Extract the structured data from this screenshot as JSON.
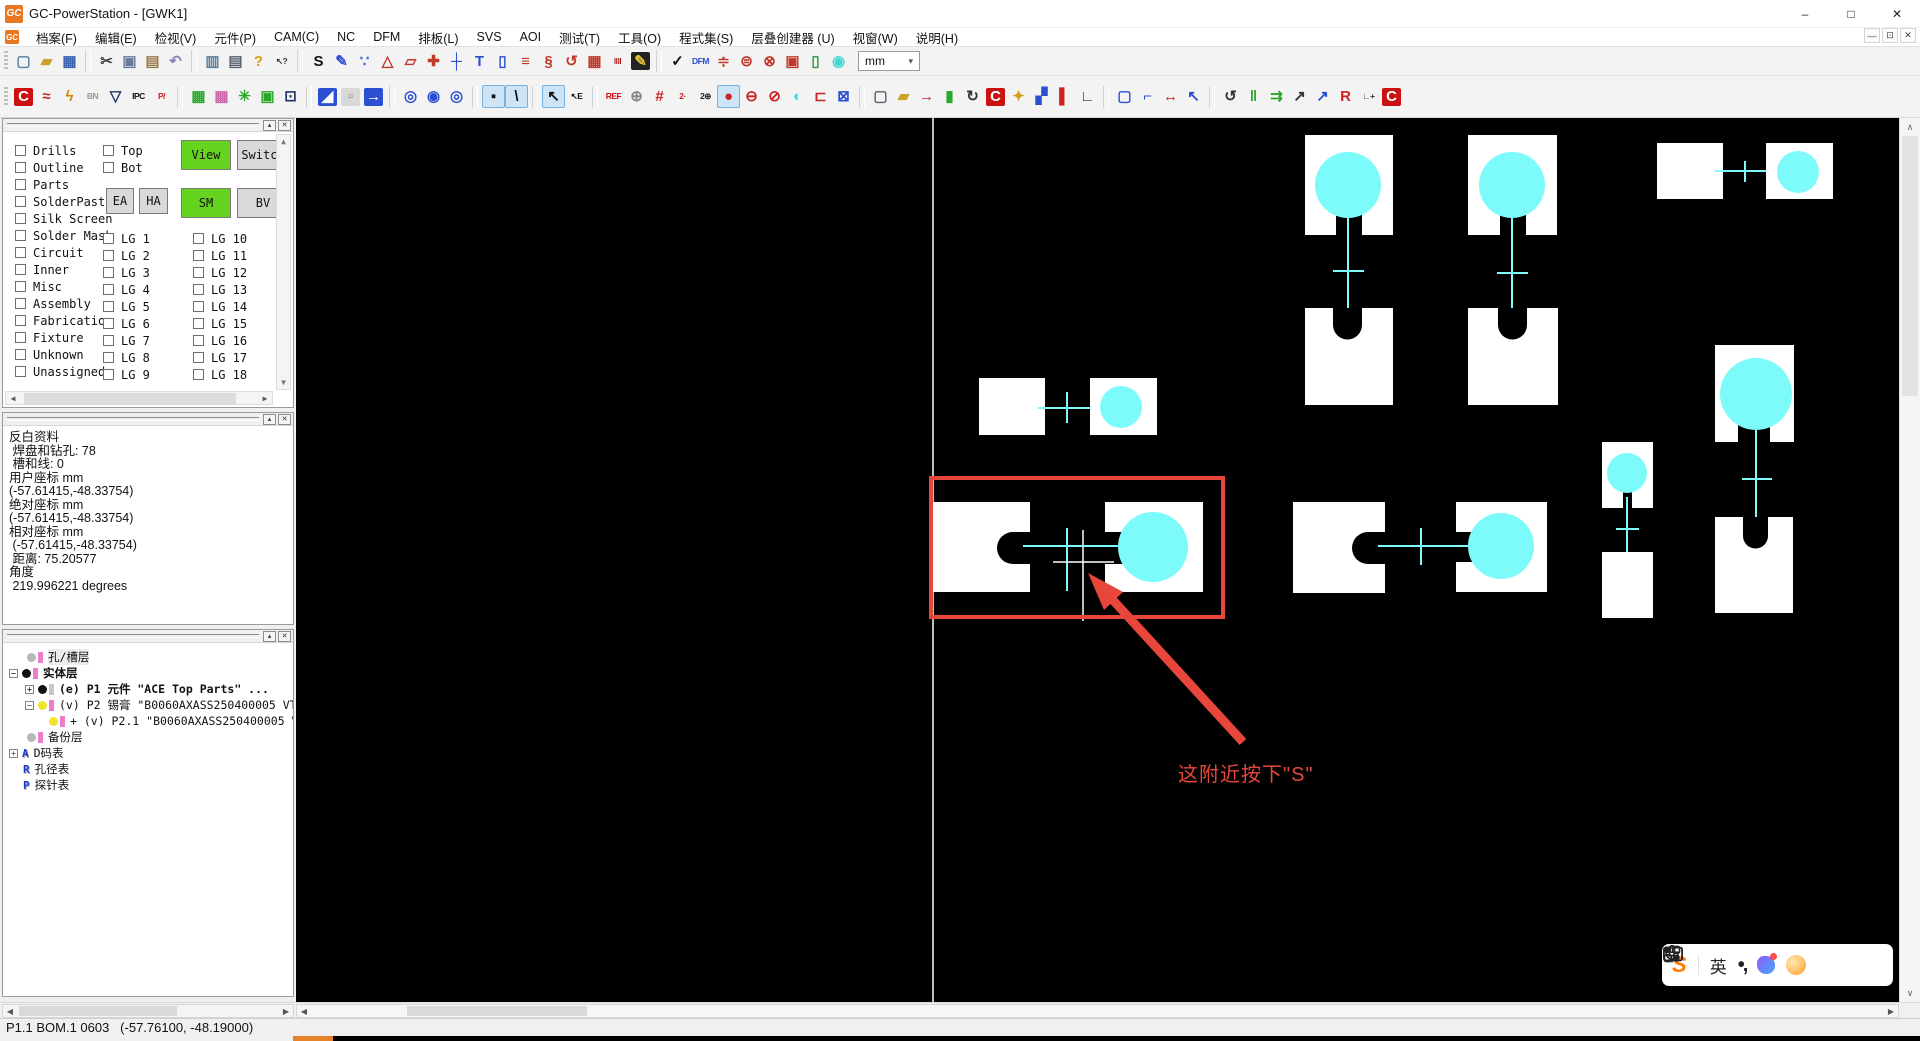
{
  "window": {
    "title": "GC-PowerStation - [GWK1]",
    "logo": "GC"
  },
  "titlebar": {
    "minimize": "–",
    "maximize": "□",
    "close": "✕"
  },
  "mdi": {
    "minimize": "—",
    "restore": "⊡",
    "close": "✕"
  },
  "menubar": {
    "items": [
      {
        "name": "menu-file",
        "label": "档案(F)"
      },
      {
        "name": "menu-edit",
        "label": "编辑(E)"
      },
      {
        "name": "menu-view",
        "label": "检视(V)"
      },
      {
        "name": "menu-part",
        "label": "元件(P)"
      },
      {
        "name": "menu-cam",
        "label": "CAM(C)"
      },
      {
        "name": "menu-nc",
        "label": "NC"
      },
      {
        "name": "menu-dfm",
        "label": "DFM"
      },
      {
        "name": "menu-layout",
        "label": "排板(L)"
      },
      {
        "name": "menu-svs",
        "label": "SVS"
      },
      {
        "name": "menu-aoi",
        "label": "AOI"
      },
      {
        "name": "menu-test",
        "label": "测试(T)"
      },
      {
        "name": "menu-tools",
        "label": "工具(O)"
      },
      {
        "name": "menu-programs",
        "label": "程式集(S)"
      },
      {
        "name": "menu-stackup",
        "label": "层叠创建器 (U)"
      },
      {
        "name": "menu-window",
        "label": "视窗(W)"
      },
      {
        "name": "menu-help",
        "label": "说明(H)"
      }
    ]
  },
  "toolbar1": {
    "items": [
      {
        "name": "new-file-button",
        "glyph": "▢",
        "fg": "#5a7da0"
      },
      {
        "name": "open-folder-button",
        "glyph": "▰",
        "fg": "#c9a227"
      },
      {
        "name": "save-button",
        "glyph": "▦",
        "fg": "#3a5fae"
      },
      {
        "type": "sep"
      },
      {
        "name": "cut-button",
        "glyph": "✂",
        "fg": "#444444"
      },
      {
        "name": "copy-button",
        "glyph": "▣",
        "fg": "#6a7a9a"
      },
      {
        "name": "paste-button",
        "glyph": "▤",
        "fg": "#9a7a4a"
      },
      {
        "name": "undo-button",
        "glyph": "↶",
        "fg": "#8a8ab0"
      },
      {
        "type": "sep"
      },
      {
        "name": "report-button",
        "glyph": "▥",
        "fg": "#5a7da0"
      },
      {
        "name": "print-button",
        "glyph": "▤",
        "fg": "#556070"
      },
      {
        "name": "help-button",
        "glyph": "?",
        "fg": "#d4a017"
      },
      {
        "name": "context-help-button",
        "glyph": "↖?",
        "fg": "#333333"
      },
      {
        "type": "sep"
      },
      {
        "name": "snap-mode-button",
        "glyph": "S",
        "fg": "#111111"
      },
      {
        "name": "draw-pencil-button",
        "glyph": "✎",
        "fg": "#2a4fd0"
      },
      {
        "name": "add-points-button",
        "glyph": "∵",
        "fg": "#2a6fd0"
      },
      {
        "name": "polyline-button",
        "glyph": "△",
        "fg": "#c03a2a"
      },
      {
        "name": "select-polygon-button",
        "glyph": "▱",
        "fg": "#c03a2a"
      },
      {
        "name": "transform-button",
        "glyph": "✚",
        "fg": "#c03a2a"
      },
      {
        "name": "axis-button",
        "glyph": "┼",
        "fg": "#2a4fd0"
      },
      {
        "name": "text-tool-button",
        "glyph": "T",
        "fg": "#2a4fd0"
      },
      {
        "name": "rect-tool-button",
        "glyph": "▯",
        "fg": "#2a4fd0"
      },
      {
        "name": "layer-stack-button",
        "glyph": "≡",
        "fg": "#c03a2a"
      },
      {
        "name": "shrink-button",
        "glyph": "§",
        "fg": "#c03a2a"
      },
      {
        "name": "rotate-sel-button",
        "glyph": "↺",
        "fg": "#c03a2a"
      },
      {
        "name": "save-layer-button",
        "glyph": "▦",
        "fg": "#c03a2a"
      },
      {
        "name": "barcode-button",
        "glyph": "‖‖",
        "fg": "#aa1111"
      },
      {
        "name": "marker-pen-button",
        "glyph": "✎",
        "fg": "#e8c23a",
        "bg": "#222222"
      },
      {
        "type": "sep"
      },
      {
        "name": "verify-check-button",
        "glyph": "✓",
        "fg": "#111111"
      },
      {
        "name": "dfm-check-button",
        "glyph": "DFM",
        "fg": "#2a4fd0"
      },
      {
        "name": "compare-stack-button",
        "glyph": "≑",
        "fg": "#c03a2a"
      },
      {
        "name": "disc-lines-button",
        "glyph": "⊜",
        "fg": "#c03a2a"
      },
      {
        "name": "disc-mesh-button",
        "glyph": "⊗",
        "fg": "#c03a2a"
      },
      {
        "name": "pad-pair-button",
        "glyph": "▣",
        "fg": "#c03a2a"
      },
      {
        "name": "outline-rect-button",
        "glyph": "▯",
        "fg": "#2a9a3a"
      },
      {
        "name": "droplet-button",
        "glyph": "◉",
        "fg": "#3fd6d6"
      }
    ]
  },
  "unit_select": {
    "value": "mm",
    "chevron": "▾"
  },
  "toolbar2": {
    "items": [
      {
        "name": "c-net-button",
        "glyph": "C",
        "fg": "#ffffff",
        "bg": "#cc1111"
      },
      {
        "name": "net-compare-button",
        "glyph": "≈",
        "fg": "#cc2222"
      },
      {
        "name": "spark-button",
        "glyph": "ϟ",
        "fg": "#cc8800"
      },
      {
        "name": "bn-tool-button",
        "glyph": "BN",
        "fg": "#999999"
      },
      {
        "name": "filter-funnel-button",
        "glyph": "▽",
        "fg": "#223366"
      },
      {
        "name": "ipc-export-button",
        "glyph": "IPC",
        "fg": "#111111"
      },
      {
        "name": "p-slash-button",
        "glyph": "P/",
        "fg": "#cc2222"
      },
      {
        "type": "sep"
      },
      {
        "name": "panel-array-button",
        "glyph": "▦",
        "fg": "#2aa82a"
      },
      {
        "name": "panel-array-alt-button",
        "glyph": "▦",
        "fg": "#cc66aa"
      },
      {
        "name": "thermal-burst-button",
        "glyph": "✳",
        "fg": "#2aa82a"
      },
      {
        "name": "pad-in-frame-button",
        "glyph": "▣",
        "fg": "#2aa82a"
      },
      {
        "name": "inspect-pad-button",
        "glyph": "⊡",
        "fg": "#223366"
      },
      {
        "type": "sep"
      },
      {
        "name": "view-full-button",
        "glyph": "◢",
        "fg": "#ffffff",
        "bg": "#2a4fd0"
      },
      {
        "name": "view-grid-button",
        "glyph": "▫",
        "fg": "#888888",
        "bg": "#d8d8d8"
      },
      {
        "name": "view-pan-button",
        "glyph": "→",
        "fg": "#ffffff",
        "bg": "#2a4fd0"
      },
      {
        "type": "sep"
      },
      {
        "name": "zoom-highlight-1-button",
        "glyph": "◎",
        "fg": "#2a4fd0"
      },
      {
        "name": "zoom-highlight-2-button",
        "glyph": "◉",
        "fg": "#2a4fd0"
      },
      {
        "name": "zoom-highlight-3-button",
        "glyph": "◎",
        "fg": "#2a4fd0"
      },
      {
        "type": "sep"
      },
      {
        "name": "point-mode-button",
        "glyph": "▪",
        "fg": "#111111",
        "hl": true
      },
      {
        "name": "line-mode-button",
        "glyph": "\\",
        "fg": "#111111",
        "hl": true
      },
      {
        "type": "sep"
      },
      {
        "name": "select-cursor-button",
        "glyph": "↖",
        "fg": "#111111",
        "hl": true
      },
      {
        "name": "select-edit-button",
        "glyph": "↖E",
        "fg": "#111111"
      },
      {
        "type": "sep"
      },
      {
        "name": "ref-grid-button",
        "glyph": "REF",
        "fg": "#cc1111"
      },
      {
        "name": "sphere-button",
        "glyph": "⊕",
        "fg": "#888888"
      },
      {
        "name": "numbering-button",
        "glyph": "#",
        "fg": "#cc2222"
      },
      {
        "name": "step2-button",
        "glyph": "2·",
        "fg": "#cc2222"
      },
      {
        "name": "target2-button",
        "glyph": "2⊕",
        "fg": "#222222"
      },
      {
        "name": "pad-ellipse-button",
        "glyph": "●",
        "fg": "#cc2222",
        "hl": true
      },
      {
        "name": "pad-line-left-button",
        "glyph": "⊖",
        "fg": "#cc2222"
      },
      {
        "name": "pad-line-mid-button",
        "glyph": "⊘",
        "fg": "#cc2222"
      },
      {
        "name": "pad-fill-cyan-button",
        "glyph": "◐",
        "fg": "#3fd6d6"
      },
      {
        "name": "pad-open-right-button",
        "glyph": "⊏",
        "fg": "#cc2222"
      },
      {
        "name": "pad-cross-frame-button",
        "glyph": "⊠",
        "fg": "#2a4fd0"
      },
      {
        "type": "sep"
      },
      {
        "name": "new-doc-button",
        "glyph": "▢",
        "fg": "#556677"
      },
      {
        "name": "open-folder2-button",
        "glyph": "▰",
        "fg": "#c9a227"
      },
      {
        "name": "import-door-button",
        "glyph": "→",
        "fg": "#cc2222"
      },
      {
        "name": "green-panel-button",
        "glyph": "▮",
        "fg": "#2aa82a"
      },
      {
        "name": "rotate-view-button",
        "glyph": "↻",
        "fg": "#333333"
      },
      {
        "name": "c-marker-button",
        "glyph": "C",
        "fg": "#ffffff",
        "bg": "#cc1111"
      },
      {
        "name": "lamp-button",
        "glyph": "✦",
        "fg": "#d4a017"
      },
      {
        "name": "split-panels-button",
        "glyph": "▞",
        "fg": "#2a4fd0"
      },
      {
        "name": "panel-cursor-button",
        "glyph": "▌",
        "fg": "#cc2222"
      },
      {
        "name": "measure-axis-button",
        "glyph": "∟",
        "fg": "#333333"
      },
      {
        "type": "sep"
      },
      {
        "name": "select-rect-dashed-button",
        "glyph": "▢",
        "fg": "#2a4fd0"
      },
      {
        "name": "corner-snap-button",
        "glyph": "⌐",
        "fg": "#2a4fd0"
      },
      {
        "name": "transform-handles-button",
        "glyph": "↔",
        "fg": "#cc2222"
      },
      {
        "name": "corner-arrow-button",
        "glyph": "↖",
        "fg": "#2a4fd0"
      },
      {
        "type": "sep"
      },
      {
        "name": "rotate-ccw-button",
        "glyph": "↺",
        "fg": "#333333"
      },
      {
        "name": "align-columns-button",
        "glyph": "‖",
        "fg": "#2aa82a"
      },
      {
        "name": "distribute-button",
        "glyph": "⇉",
        "fg": "#2aa82a"
      },
      {
        "name": "chart-rise-button",
        "glyph": "↗",
        "fg": "#333333"
      },
      {
        "name": "chart-rise2-button",
        "glyph": "↗",
        "fg": "#2a4fd0"
      },
      {
        "name": "r-layers-button",
        "glyph": "R",
        "fg": "#cc2222"
      },
      {
        "name": "chart-add-button",
        "glyph": "∟+",
        "fg": "#333333"
      },
      {
        "name": "c-stop-button",
        "glyph": "C",
        "fg": "#ffffff",
        "bg": "#cc1111"
      }
    ]
  },
  "layers_panel": {
    "categories": [
      {
        "name": "layer-drills-checkbox",
        "label": "Drills"
      },
      {
        "name": "layer-outline-checkbox",
        "label": "Outline"
      },
      {
        "name": "layer-parts-checkbox",
        "label": "Parts"
      },
      {
        "name": "layer-solderpaste-checkbox",
        "label": "SolderPaste"
      },
      {
        "name": "layer-silk-screen-checkbox",
        "label": "Silk Screen"
      },
      {
        "name": "layer-solder-mask-checkbox",
        "label": "Solder Mask"
      },
      {
        "name": "layer-circuit-checkbox",
        "label": "Circuit"
      },
      {
        "name": "layer-inner-checkbox",
        "label": "Inner"
      },
      {
        "name": "layer-misc-checkbox",
        "label": "Misc"
      },
      {
        "name": "layer-assembly-checkbox",
        "label": "Assembly"
      },
      {
        "name": "layer-fabrication-checkbox",
        "label": "Fabrication"
      },
      {
        "name": "layer-fixture-checkbox",
        "label": "Fixture"
      },
      {
        "name": "layer-unknown-checkbox",
        "label": "Unknown"
      },
      {
        "name": "layer-unassigned-checkbox",
        "label": "Unassigned"
      }
    ],
    "sides": [
      {
        "name": "side-top-checkbox",
        "label": "Top"
      },
      {
        "name": "side-bot-checkbox",
        "label": "Bot"
      }
    ],
    "buttons": {
      "view": "View",
      "switch": "Switch",
      "ea": "EA",
      "ha": "HA",
      "sm": "SM",
      "bv": "BV"
    },
    "lg_left": [
      {
        "name": "lg-1-checkbox",
        "label": "LG 1"
      },
      {
        "name": "lg-2-checkbox",
        "label": "LG 2"
      },
      {
        "name": "lg-3-checkbox",
        "label": "LG 3"
      },
      {
        "name": "lg-4-checkbox",
        "label": "LG 4"
      },
      {
        "name": "lg-5-checkbox",
        "label": "LG 5"
      },
      {
        "name": "lg-6-checkbox",
        "label": "LG 6"
      },
      {
        "name": "lg-7-checkbox",
        "label": "LG 7"
      },
      {
        "name": "lg-8-checkbox",
        "label": "LG 8"
      },
      {
        "name": "lg-9-checkbox",
        "label": "LG 9"
      }
    ],
    "lg_right": [
      {
        "name": "lg-10-checkbox",
        "label": "LG 10"
      },
      {
        "name": "lg-11-checkbox",
        "label": "LG 11"
      },
      {
        "name": "lg-12-checkbox",
        "label": "LG 12"
      },
      {
        "name": "lg-13-checkbox",
        "label": "LG 13"
      },
      {
        "name": "lg-14-checkbox",
        "label": "LG 14"
      },
      {
        "name": "lg-15-checkbox",
        "label": "LG 15"
      },
      {
        "name": "lg-16-checkbox",
        "label": "LG 16"
      },
      {
        "name": "lg-17-checkbox",
        "label": "LG 17"
      },
      {
        "name": "lg-18-checkbox",
        "label": "LG 18"
      }
    ]
  },
  "info_panel": {
    "lines": [
      {
        "text": "反白资料"
      },
      {
        "text": " 焊盘和钻孔: 78"
      },
      {
        "text": " 槽和线: 0"
      },
      {
        "text": "用户座标 mm"
      },
      {
        "text": "(-57.61415,-48.33754)"
      },
      {
        "text": "绝对座标 mm"
      },
      {
        "text": "(-57.61415,-48.33754)"
      },
      {
        "text": "相对座标 mm"
      },
      {
        "text": " (-57.61415,-48.33754)"
      },
      {
        "text": " 距离: 75.20577"
      },
      {
        "text": "角度"
      },
      {
        "text": " 219.996221 degrees"
      }
    ]
  },
  "tree_panel": {
    "items": [
      {
        "label": "孔/槽层"
      },
      {
        "label": "实体层"
      },
      {
        "label": "(e) P1 元件 \"ACE Top Parts\" ..."
      },
      {
        "label": "(v) P2 锡膏 \"B0060AXASS250400005 VTP1"
      },
      {
        "label": "+ (v) P2.1 \"B0060AXASS250400005 V."
      },
      {
        "label": "备份层"
      },
      {
        "label": "D码表"
      },
      {
        "label": "孔径表"
      },
      {
        "label": "探针表"
      }
    ]
  },
  "canvas": {
    "annotation": "这附近按下\"S\"",
    "colors": {
      "background": "#000000",
      "pad": "#ffffff",
      "hole": "#7dfbfb",
      "highlight": "#e8463b",
      "crosshair": "#ffffff"
    }
  },
  "input_bar": {
    "logo": "S",
    "lang": "英",
    "punctuation": "•,"
  },
  "statusbar": {
    "text": "P1.1 BOM.1 0603   (-57.76100, -48.19000)"
  }
}
